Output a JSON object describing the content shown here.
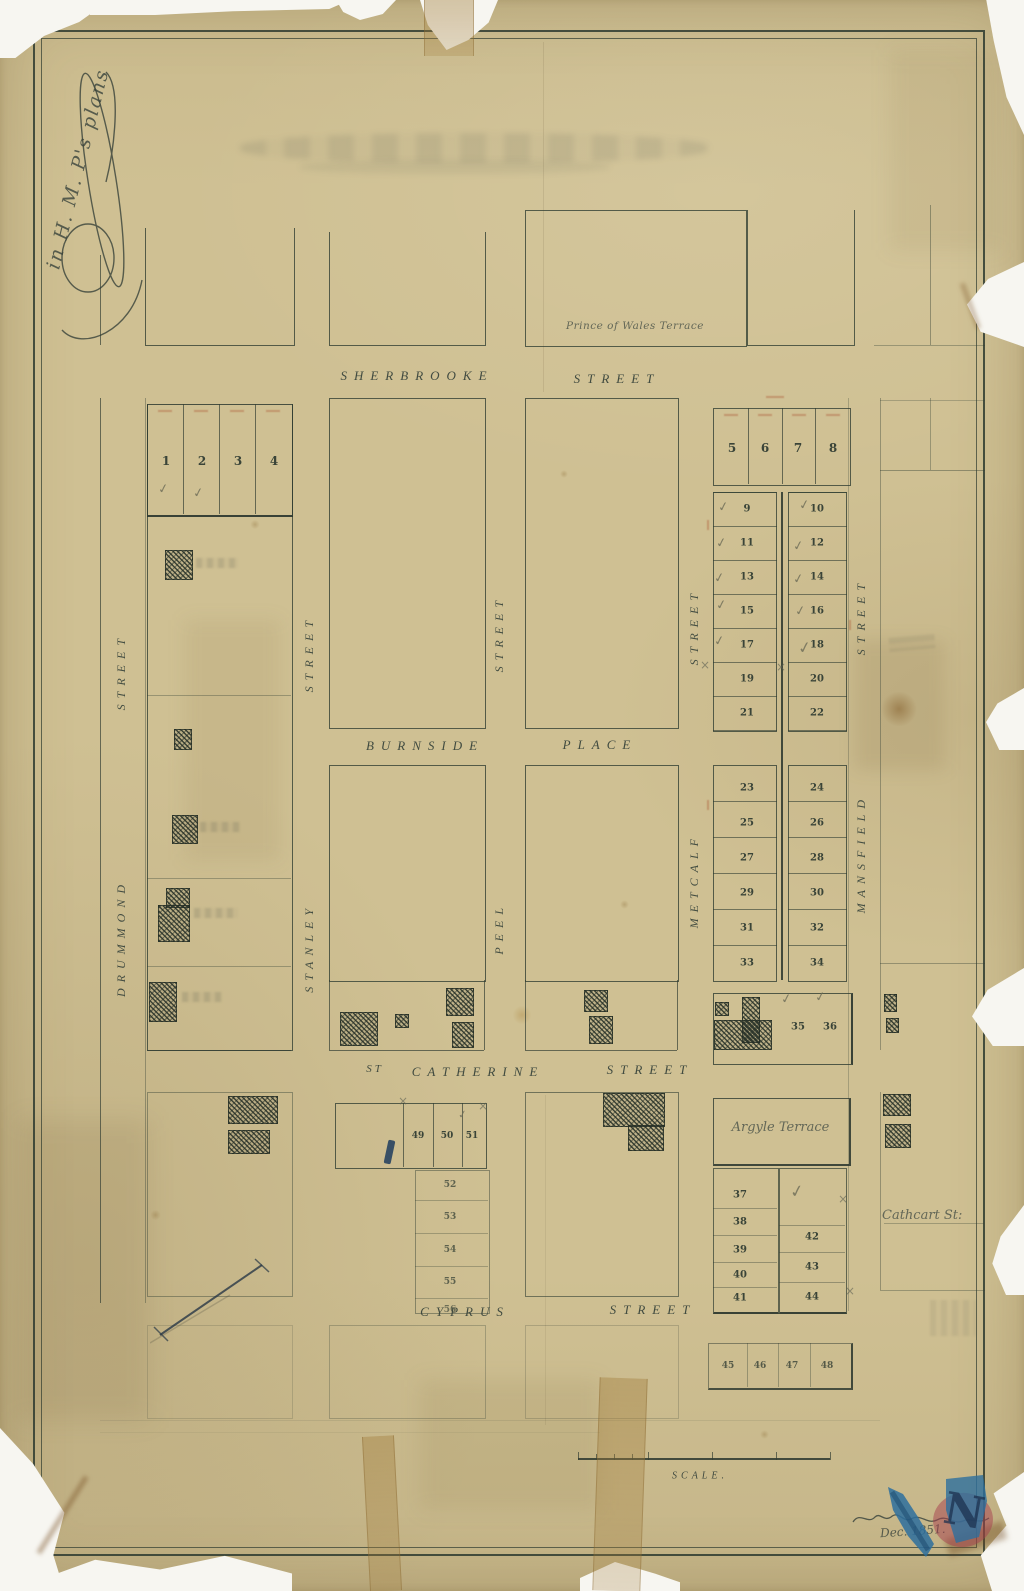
{
  "handwritten": {
    "corner_note": "in  H. M. P's  plans",
    "prince_of_wales": "Prince of Wales Terrace",
    "argyle_terrace": "Argyle Terrace",
    "cathcart": "Cathcart St:",
    "signature_date": "Dec. 1851."
  },
  "streets": {
    "sherbrooke": {
      "w1": "SHERBROOKE",
      "w2": "STREET"
    },
    "burnside": {
      "w1": "BURNSIDE",
      "w2": "PLACE"
    },
    "st_catherine": {
      "w1": "ST",
      "w2": "CATHERINE",
      "w3": "STREET"
    },
    "cyprus": {
      "w1": "CYPRUS",
      "w2": "STREET"
    },
    "drummond": {
      "name": "DRUMMOND",
      "word": "STREET"
    },
    "stanley": {
      "name": "STANLEY",
      "word": "STREET"
    },
    "peel": {
      "name": "PEEL",
      "word": "STREET"
    },
    "metcalf": {
      "name": "METCALF",
      "word": "STREET"
    },
    "mansfield": {
      "name": "MANSFIELD",
      "word": "STREET"
    }
  },
  "lots": {
    "row1": [
      "1",
      "2",
      "3",
      "4"
    ],
    "row5": [
      "5",
      "6",
      "7",
      "8"
    ],
    "col9": [
      "9",
      "11",
      "13",
      "15",
      "17",
      "19",
      "21"
    ],
    "col10": [
      "10",
      "12",
      "14",
      "16",
      "18",
      "20",
      "22"
    ],
    "col23": [
      "23",
      "25",
      "27",
      "29",
      "31",
      "33"
    ],
    "col24": [
      "24",
      "26",
      "28",
      "30",
      "32",
      "34"
    ],
    "pair35": [
      "35",
      "36"
    ],
    "col37": [
      "37",
      "38",
      "39",
      "40",
      "41"
    ],
    "col42": [
      "42",
      "43",
      "44"
    ],
    "row45": [
      "45",
      "46",
      "47",
      "48"
    ],
    "row49": [
      "49",
      "50",
      "51"
    ],
    "col52": [
      "52",
      "53",
      "54",
      "55",
      "56"
    ]
  },
  "scale": {
    "label": "SCALE."
  },
  "stamp": {
    "letter": "N"
  },
  "glyphs": {
    "check": "✓",
    "x": "×"
  }
}
